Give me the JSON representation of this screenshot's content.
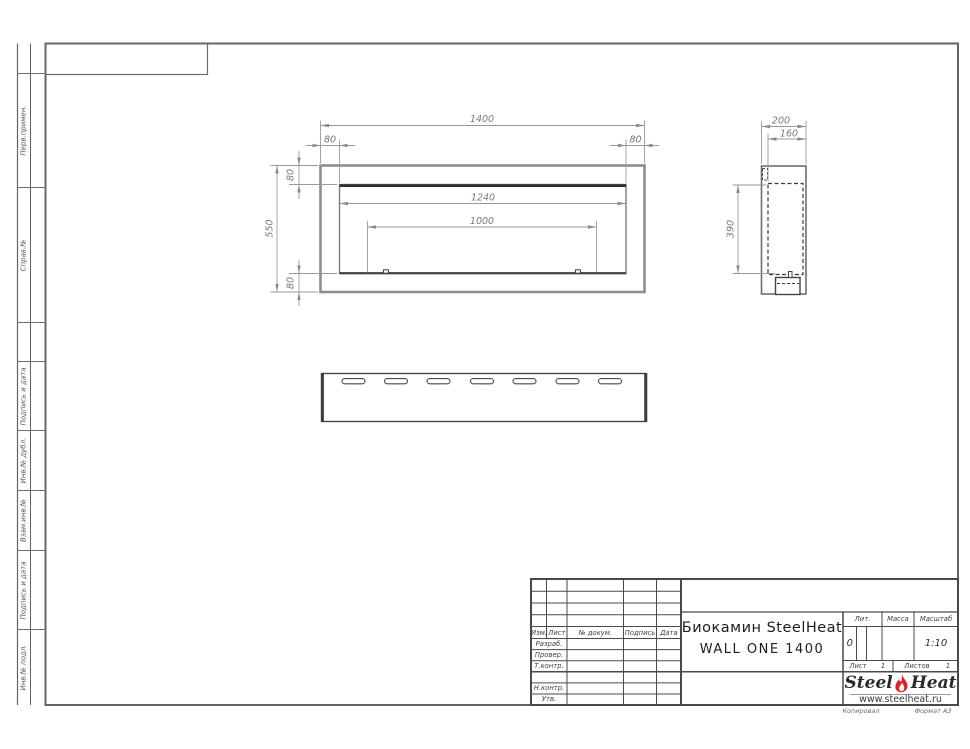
{
  "colors": {
    "flame_red": "#e31e24",
    "line_dark": "#3a3a3a",
    "line_gray": "#8e8e8e",
    "dim_gray": "#8a8a8a"
  },
  "margin": {
    "perv": "Перв.примен.",
    "sprav": "Справ.№",
    "podp1": "Подпись и дата",
    "inv_dubl": "Инв.№ дубл.",
    "vzam": "Взам.инв.№",
    "podp2": "Подпись и дата",
    "inv_podl": "Инв.№ подл."
  },
  "dims": {
    "front_width": "1400",
    "front_top_left": "80",
    "front_top_right": "80",
    "front_left_top": "80",
    "front_height": "550",
    "front_left_bottom": "80",
    "opening_width": "1240",
    "burner_width": "1000",
    "side_depth": "200",
    "side_inner_depth": "160",
    "side_opening_height": "390"
  },
  "title_block": {
    "header": {
      "izm": "Изм.",
      "list": "Лист",
      "doc": "№ докум.",
      "podpis": "Подпись",
      "data": "Дата"
    },
    "rows": {
      "razrab": "Разраб.",
      "prover": "Провер.",
      "tkontr": "Т.контр.",
      "nkontr": "Н.контр.",
      "utv": "Утв."
    },
    "title_line1": "Биокамин SteelHeat",
    "title_line2": "WALL ONE 1400",
    "lit_label": "Лит.",
    "mass_label": "Масса",
    "scale_label": "Масштаб",
    "lit_value": "0",
    "scale_value": "1:10",
    "sheet_label": "Лист",
    "sheet_value": "1",
    "sheets_label": "Листов",
    "sheets_value": "1"
  },
  "logo": {
    "steel": "Steel",
    "heat": "Heat",
    "url": "www.steelheat.ru"
  },
  "footer": {
    "copied": "Копировал",
    "format": "Формат А3"
  }
}
